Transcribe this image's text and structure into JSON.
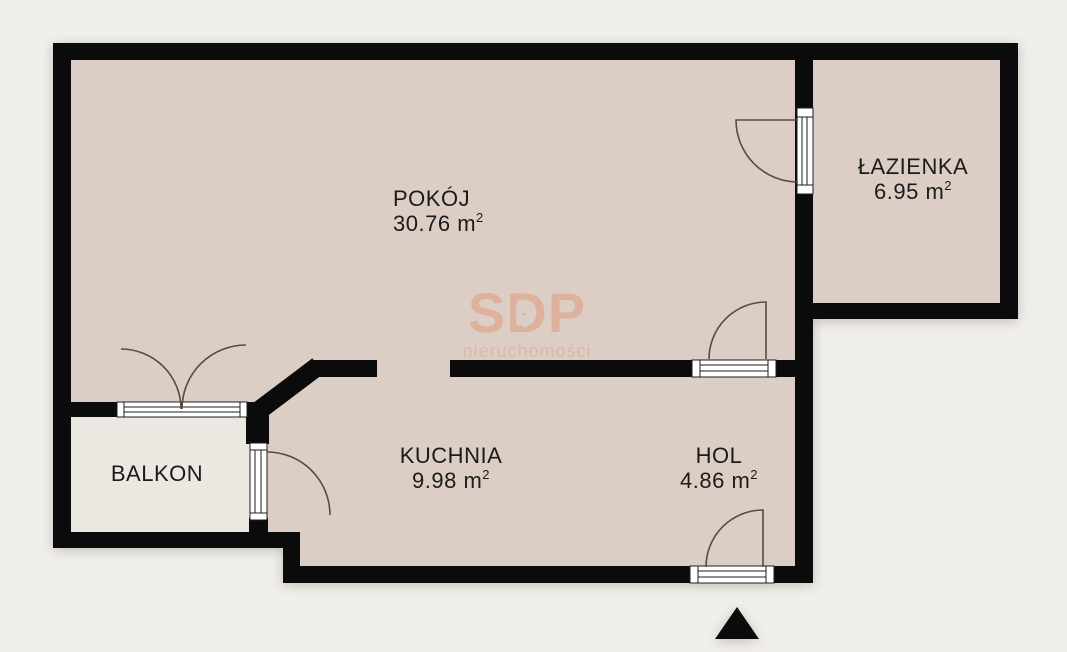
{
  "plan": {
    "title": "apartment-floor-plan",
    "rooms": [
      {
        "id": "pokoj",
        "name": "POKÓJ",
        "area": "30.76"
      },
      {
        "id": "lazienka",
        "name": "ŁAZIENKA",
        "area": "6.95"
      },
      {
        "id": "kuchnia",
        "name": "KUCHNIA",
        "area": "9.98"
      },
      {
        "id": "hol",
        "name": "HOL",
        "area": "4.86"
      },
      {
        "id": "balkon",
        "name": "BALKON",
        "area": null
      }
    ],
    "units": {
      "symbol": "m",
      "exponent": "2"
    }
  },
  "watermark": {
    "brand": "SDP",
    "subtitle": "nieruchomości"
  },
  "colors": {
    "background": "#f1efeb",
    "floor": "#dccec5",
    "balcony_floor": "#ebe8e2",
    "wall": "#0b0b0b",
    "arc_stroke": "#5a4b40",
    "watermark": "#e09474"
  }
}
